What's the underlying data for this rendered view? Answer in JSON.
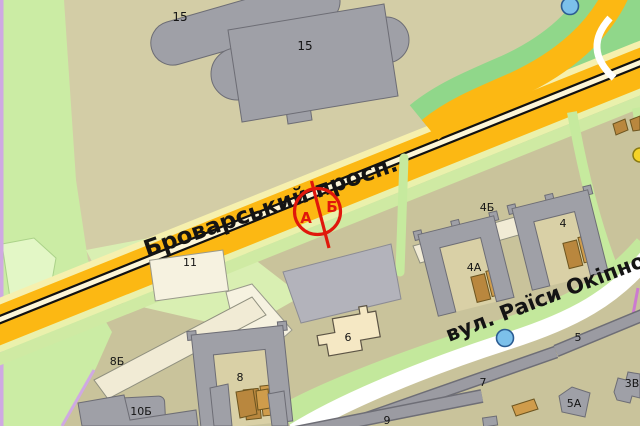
{
  "streets": {
    "avenue": "Броварський просп.",
    "street": "вул. Раїси Окіпної"
  },
  "marker": {
    "a": "А",
    "b": "Б"
  },
  "labels": {
    "b15_upper": "15",
    "b15_lower": "15",
    "b11": "11",
    "b4b": "4Б",
    "b4": "4",
    "b4a": "4А",
    "b8b": "8Б",
    "b8": "8",
    "b10b": "10Б",
    "b6": "6",
    "b7": "7",
    "b5": "5",
    "b9": "9",
    "b5a": "5А",
    "b3v": "3В"
  },
  "colors": {
    "road_yellow": "#fcb813",
    "road_white": "#ffffff",
    "park_green": "#90d78a",
    "verge_green": "#cfeaa3",
    "background_khaki": "#d3cda6",
    "building_gray": "#9fa0a7",
    "building_light": "#f1ebd5",
    "garage_brown": "#b9873e",
    "marker_red": "#e0170b",
    "poi_blue": "#7cc0ea",
    "boundary_purple": "#cfa9e2"
  }
}
